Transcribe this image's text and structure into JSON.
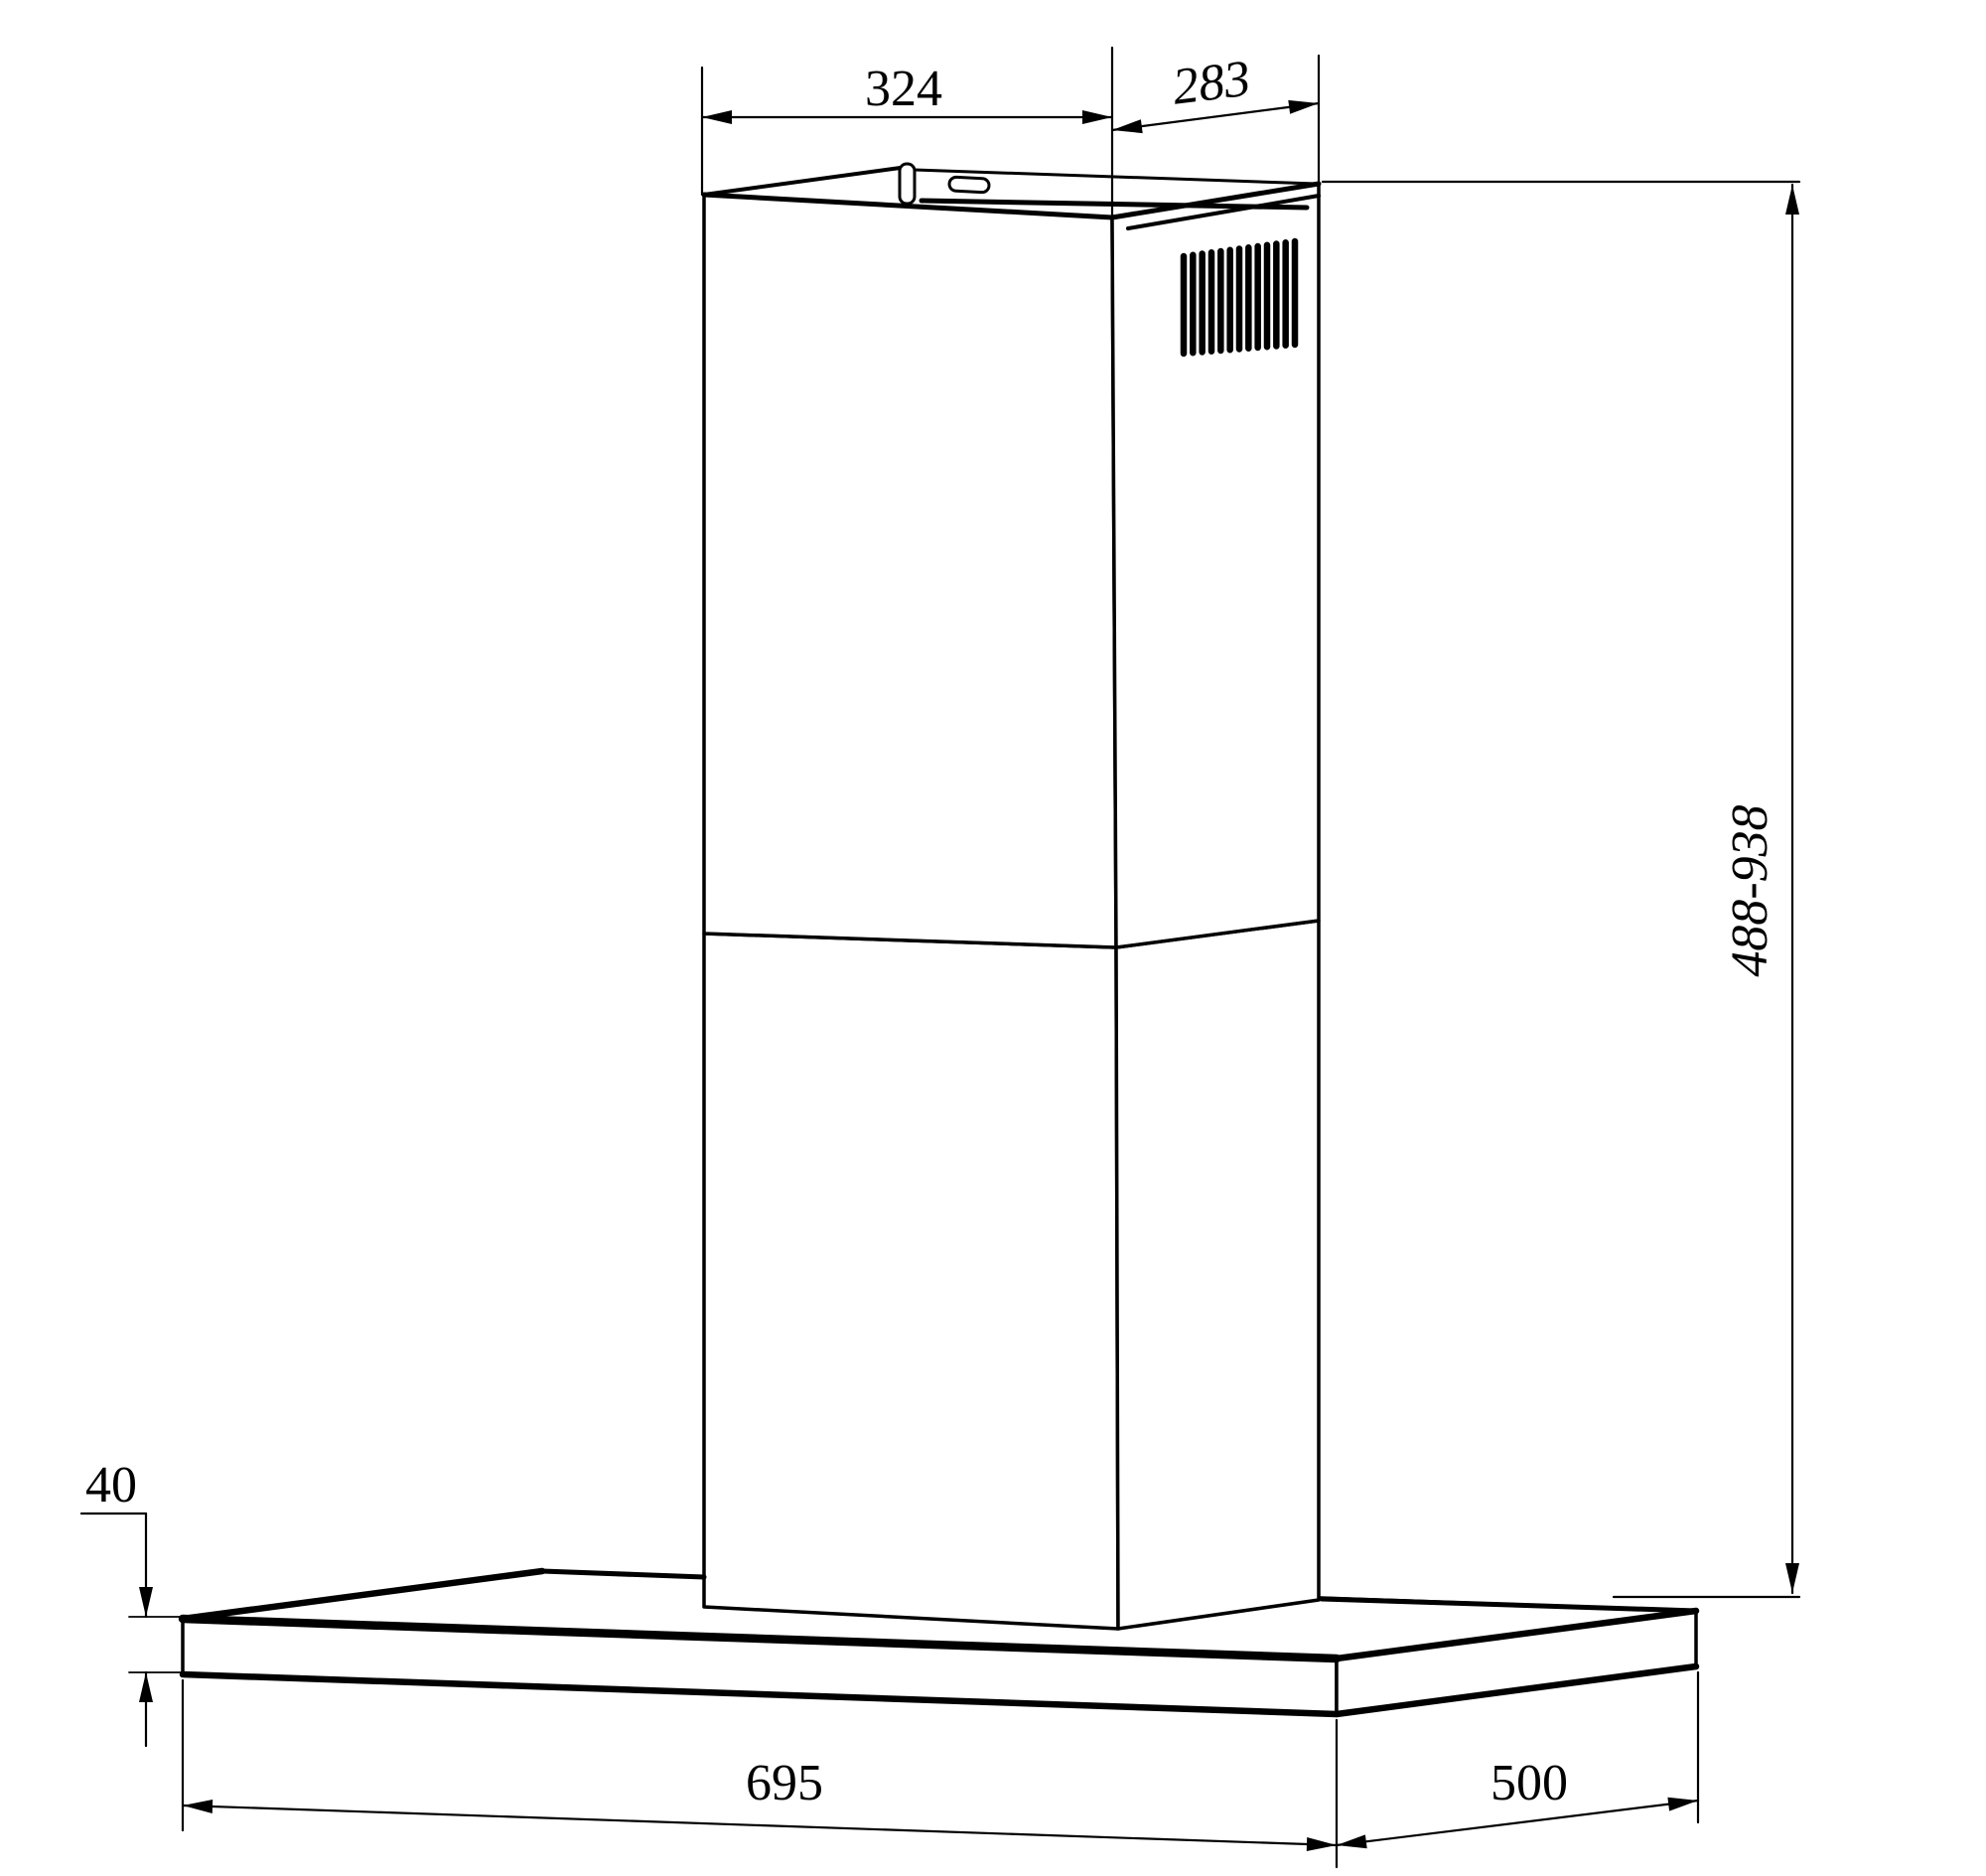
{
  "drawing": {
    "dimensions": {
      "top_width_mm": "324",
      "top_depth_mm": "283",
      "height_range_mm": "488-938",
      "base_thickness_mm": "40",
      "base_width_mm": "695",
      "base_depth_mm": "500"
    },
    "grille": {
      "slat_count": 13
    },
    "colors": {
      "line": "#000000",
      "background": "#ffffff"
    }
  }
}
